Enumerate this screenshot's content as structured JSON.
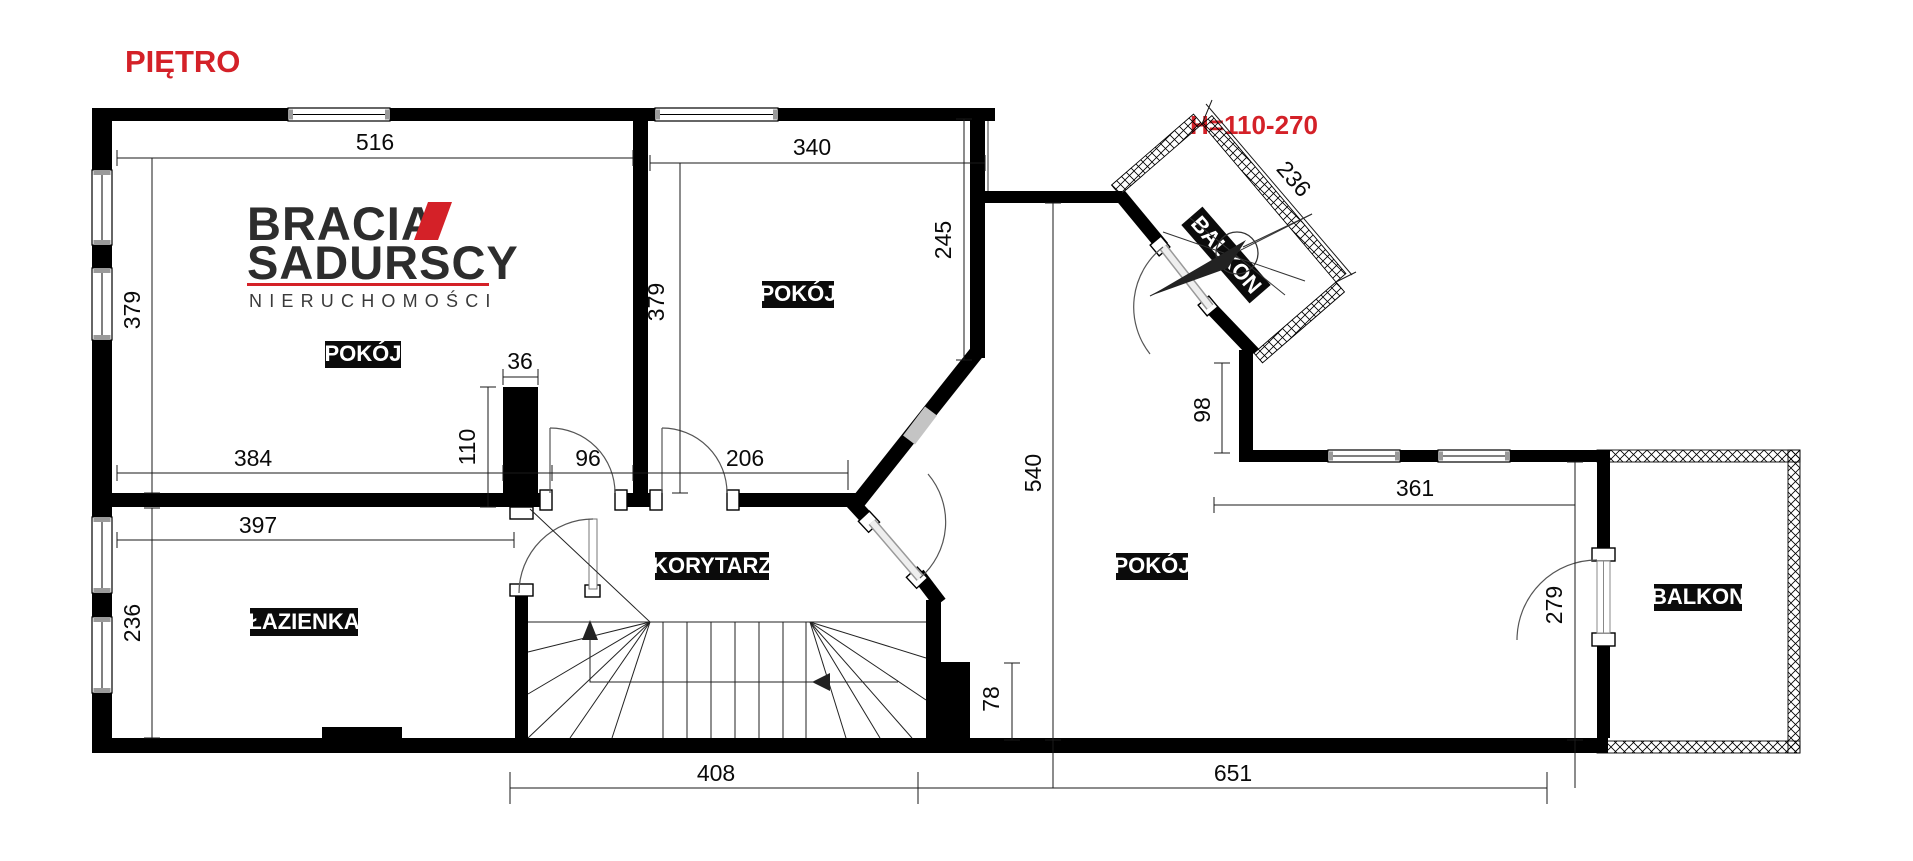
{
  "title": "PIĘTRO",
  "height_note": "H=110-270",
  "logo": {
    "line1": "BRACIA",
    "line2": "SADURSCY",
    "line3": "NIERUCHOMOŚCI"
  },
  "rooms": {
    "room1": "POKÓJ",
    "room2": "POKÓJ",
    "room3": "POKÓJ",
    "bathroom": "ŁAZIENKA",
    "corridor": "KORYTARZ",
    "balcony_top": "BALKON",
    "balcony_right": "BALKON"
  },
  "dims": {
    "room1_width": "516",
    "room1_height": "379",
    "room2_width": "340",
    "room2_height": "379",
    "room2_right": "245",
    "chimney_width": "36",
    "chimney_height": "110",
    "room1_bottom": "384",
    "door_room1": "96",
    "door_room2": "206",
    "bathroom_width": "397",
    "bathroom_height": "236",
    "hall_height": "540",
    "nook_height": "98",
    "balcony_top_length": "236",
    "room3_width": "361",
    "room3_right_height": "279",
    "block_height": "78",
    "bottom_left": "408",
    "bottom_right": "651"
  },
  "colors": {
    "accent_red": "#d42128",
    "wall": "#000000",
    "label_bg": "#0b0b0b",
    "label_text": "#ffffff"
  }
}
